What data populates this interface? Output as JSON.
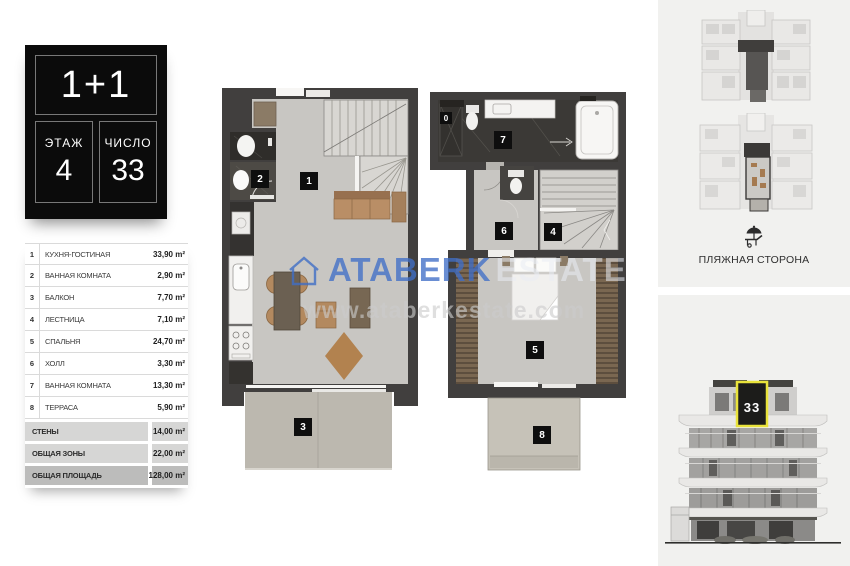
{
  "unit_card": {
    "type": "1+1",
    "floor": {
      "label": "ЭТАЖ",
      "value": "4"
    },
    "number": {
      "label": "ЧИСЛО",
      "value": "33"
    }
  },
  "area_table": {
    "rows": [
      {
        "num": "1",
        "name": "КУХНЯ-ГОСТИНАЯ",
        "area": "33,90 m²"
      },
      {
        "num": "2",
        "name": "ВАННАЯ КОМНАТА",
        "area": "2,90 m²"
      },
      {
        "num": "3",
        "name": "БАЛКОН",
        "area": "7,70 m²"
      },
      {
        "num": "4",
        "name": "ЛЕСТНИЦА",
        "area": "7,10 m²"
      },
      {
        "num": "5",
        "name": "СПАЛЬНЯ",
        "area": "24,70 m²"
      },
      {
        "num": "6",
        "name": "ХОЛЛ",
        "area": "3,30 m²"
      },
      {
        "num": "7",
        "name": "ВАННАЯ КОМНАТА",
        "area": "13,30 m²"
      },
      {
        "num": "8",
        "name": "ТЕРРАСА",
        "area": "5,90 m²"
      }
    ],
    "summary": [
      {
        "name": "СТЕНЫ",
        "area": "14,00 m²",
        "strong": false
      },
      {
        "name": "ОБЩАЯ ЗОНЫ",
        "area": "22,00 m²",
        "strong": false
      },
      {
        "name": "ОБЩАЯ ПЛОЩАДЬ",
        "area": "128,00 m²",
        "strong": true
      }
    ]
  },
  "floor_plans": {
    "lower": {
      "labels": [
        {
          "n": "1",
          "x": 300,
          "y": 172
        },
        {
          "n": "2",
          "x": 251,
          "y": 170
        },
        {
          "n": "3",
          "x": 294,
          "y": 418
        }
      ]
    },
    "upper": {
      "labels": [
        {
          "n": "0",
          "x": 440,
          "y": 112,
          "small": true
        },
        {
          "n": "7",
          "x": 494,
          "y": 131
        },
        {
          "n": "6",
          "x": 495,
          "y": 222
        },
        {
          "n": "4",
          "x": 544,
          "y": 223
        },
        {
          "n": "5",
          "x": 526,
          "y": 341
        },
        {
          "n": "8",
          "x": 533,
          "y": 426
        }
      ]
    }
  },
  "watermark": {
    "brand_bold": "ATABERK",
    "brand_light": "ESTATE",
    "url": "www.ataberkestate.com",
    "brand_color": "#406ec6"
  },
  "location_panel": {
    "beach_side": "ПЛЯЖНАЯ СТОРОНА"
  },
  "elevation_panel": {
    "unit_number": "33",
    "highlight_color": "#e9e33b"
  }
}
